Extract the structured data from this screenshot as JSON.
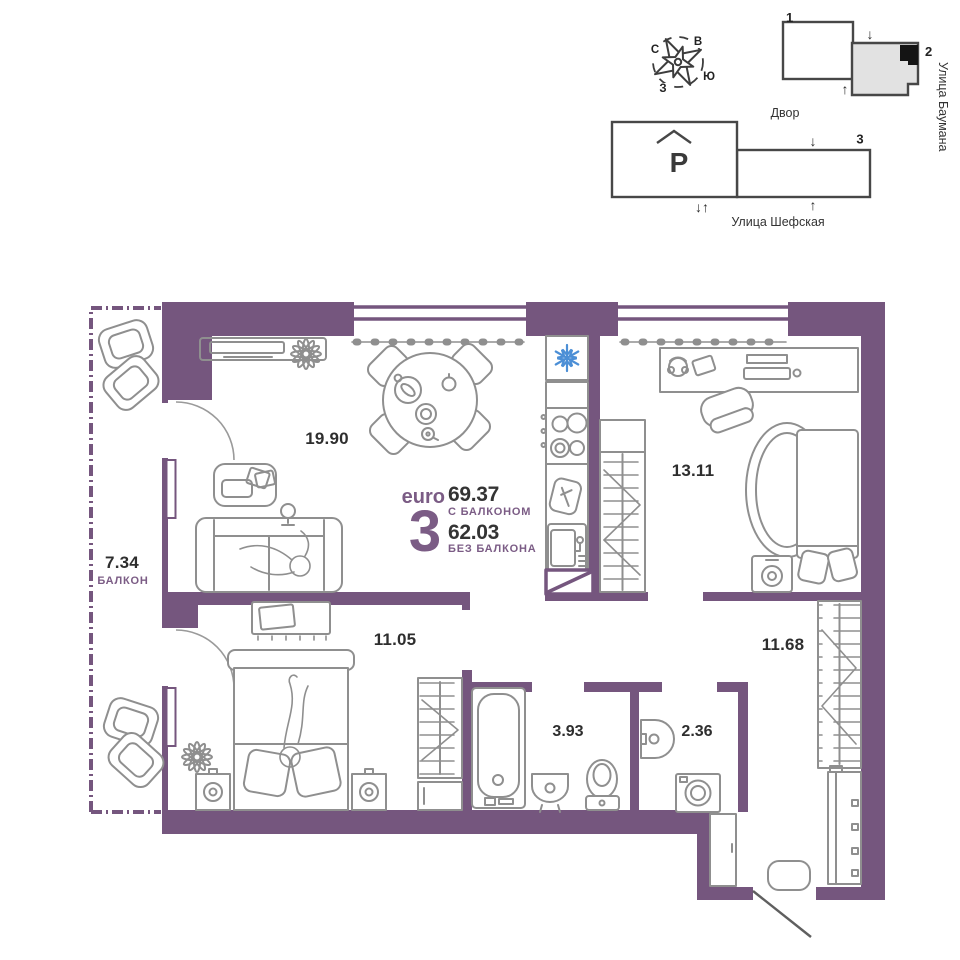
{
  "site_plan": {
    "compass": {
      "north": "С",
      "east": "В",
      "south": "Ю",
      "west": "З"
    },
    "buildings": {
      "b1": "1",
      "b2": "2",
      "b3": "3"
    },
    "yard_label": "Двор",
    "street_right": "Улица Баумана",
    "street_bottom": "Улица Шефская",
    "parking_label": "P",
    "arrow_down": "↓",
    "arrow_up": "↑",
    "arrow_down_up": "↓↑"
  },
  "apartment": {
    "format_label": "euro",
    "format_rooms": "3",
    "area_with_balcony": "69.37",
    "with_balcony_caption": "С БАЛКОНОМ",
    "area_without_balcony": "62.03",
    "without_balcony_caption": "БЕЗ БАЛКОНА"
  },
  "rooms": {
    "living_kitchen_area": "19.90",
    "bedroom_large_area": "13.11",
    "bedroom_small_area": "11.05",
    "hallway_area": "11.68",
    "bathroom_area": "3.93",
    "wc_area": "2.36",
    "balcony_area": "7.34",
    "balcony_caption": "БАЛКОН"
  },
  "colors": {
    "wall": "#75567E",
    "accent_text": "#7B5C85",
    "dark_text": "#2E2E2E",
    "furniture_stroke": "#8F8F8F",
    "snowflake_blue": "#4C8FD6",
    "site_outline": "#474747",
    "building_fill": "#E2E2E2",
    "unit_marker": "#141414"
  }
}
